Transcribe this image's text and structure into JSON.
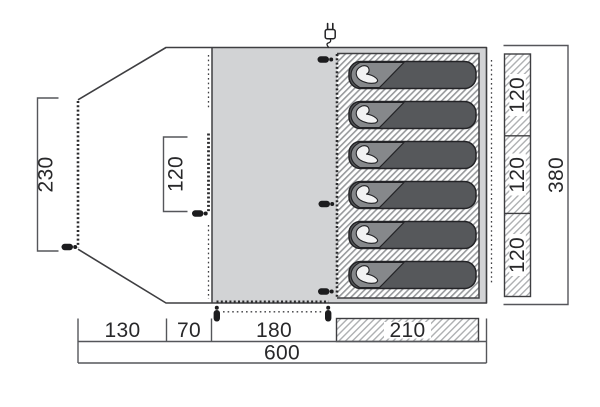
{
  "diagram": {
    "type": "tent-floorplan",
    "description": "Top view floor plan of a 6-person tent with porch, living area and sleeping cabin"
  },
  "dimensions": {
    "porch_depth": "230",
    "inner_door_width": "120",
    "bottom_segments": [
      "130",
      "70",
      "180",
      "210"
    ],
    "total_width": "600",
    "berth_widths": [
      "120",
      "120",
      "120"
    ],
    "total_depth": "380"
  },
  "features": {
    "sleeping_bag_count": 6,
    "power_inlet_icon": "plug-icon",
    "zipper_pull_icon": "zipper-pull-icon"
  },
  "colors": {
    "floor_gray": "#d2d3d5",
    "outline": "#3e3e41",
    "dimension_line": "#55565a",
    "text": "#28282a",
    "sleeping_bag": "#56585b",
    "bag_fold": "#86888b",
    "person": "#f2f2f3",
    "hatch_stripe": "#97999c",
    "bar_hatch_stripe": "#aeb0b2",
    "zipper_pull": "#1c1c1e"
  }
}
